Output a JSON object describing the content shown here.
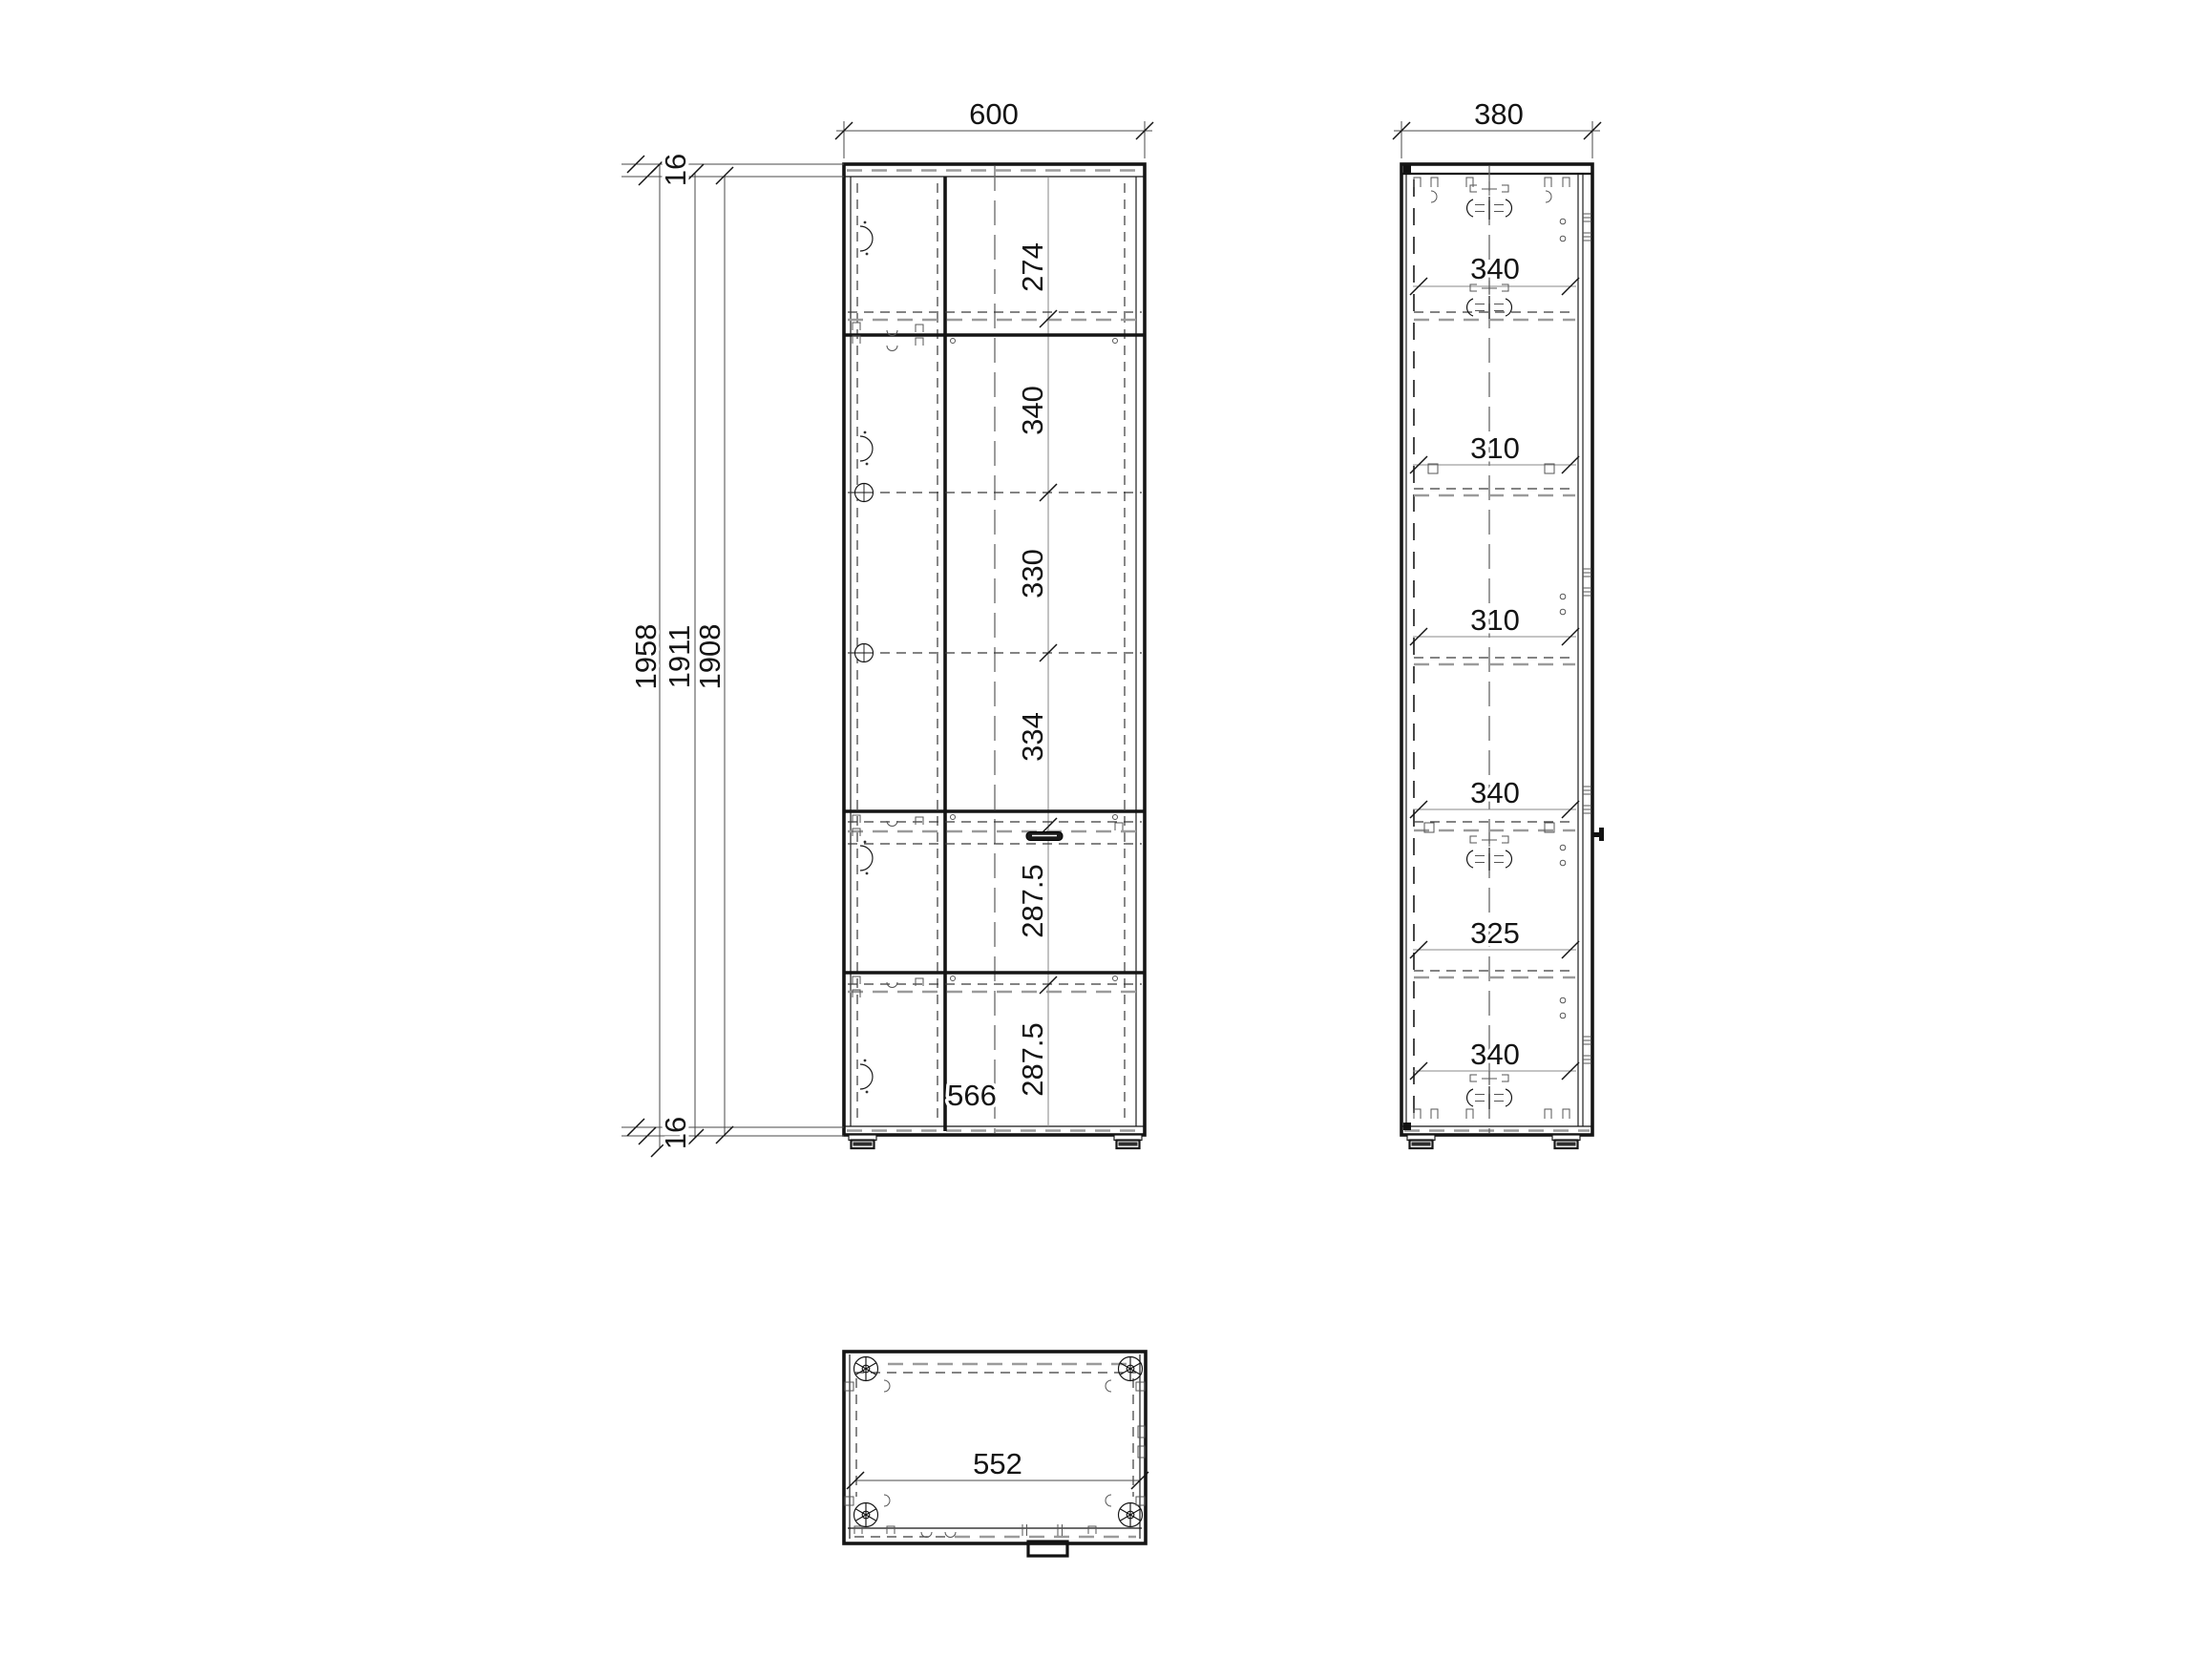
{
  "front_view": {
    "width_dim": "600",
    "interior_width_dim": "566",
    "top_panel_dim": "16",
    "bottom_panel_dim": "16",
    "height_dims": {
      "overall": "1958",
      "door": "1911",
      "carcass": "1908"
    },
    "section_dims": [
      "274",
      "340",
      "330",
      "334",
      "287.5",
      "287.5"
    ]
  },
  "side_view": {
    "depth_dim": "380",
    "section_dims": [
      "340",
      "310",
      "310",
      "340",
      "325",
      "340"
    ]
  },
  "top_view": {
    "width_dim": "552"
  }
}
